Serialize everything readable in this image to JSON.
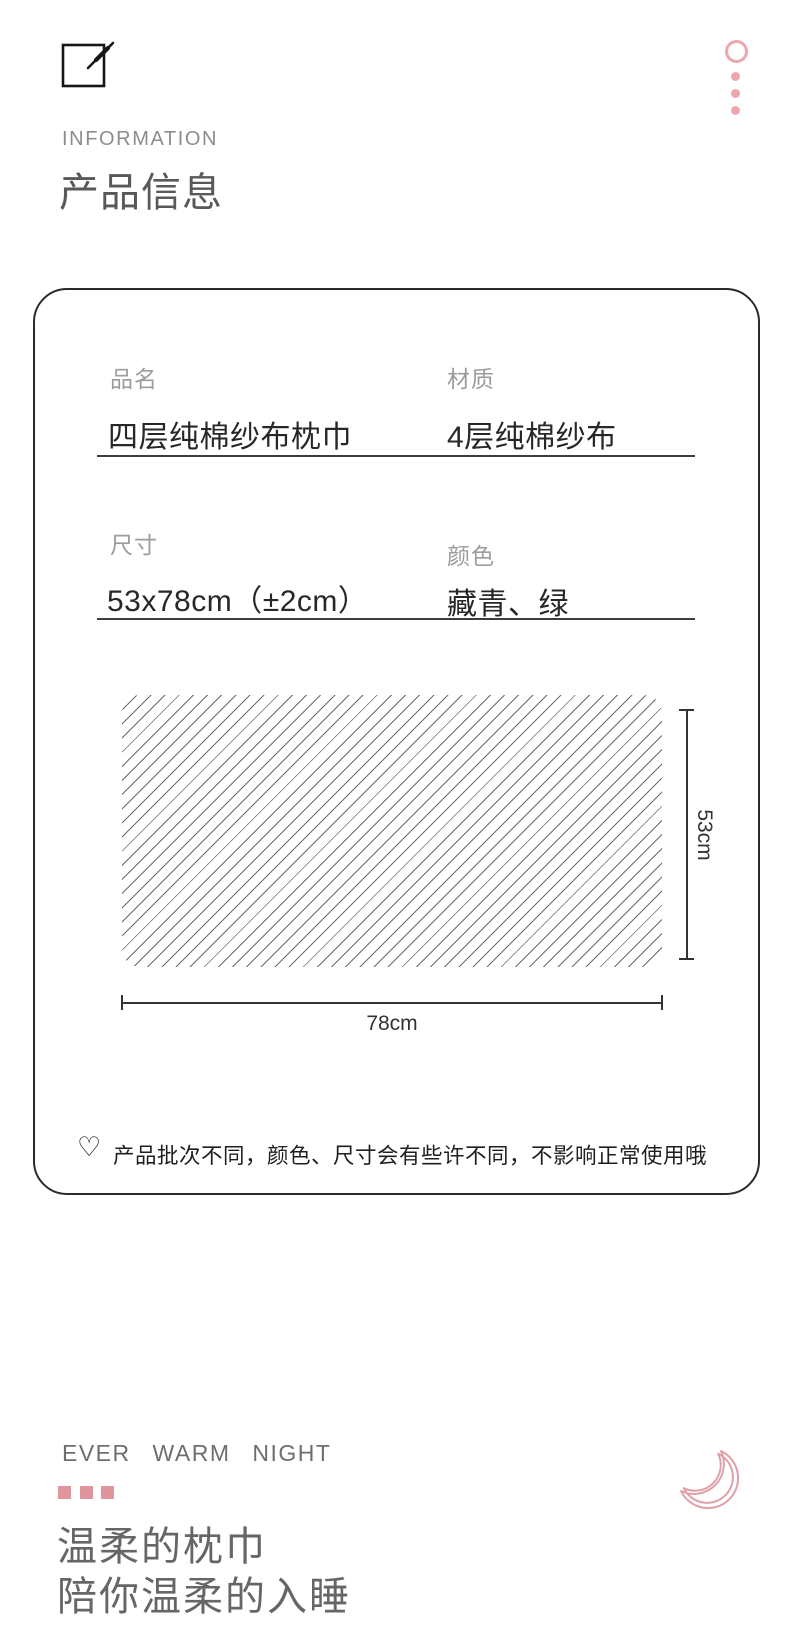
{
  "header": {
    "eyebrow": "INFORMATION",
    "title": "产品信息"
  },
  "card": {
    "fields": [
      {
        "label": "品名",
        "value": "四层纯棉纱布枕巾"
      },
      {
        "label": "材质",
        "value": "4层纯棉纱布"
      },
      {
        "label": "尺寸",
        "value": "53x78cm（±2cm）"
      },
      {
        "label": "颜色",
        "value": "藏青、绿"
      }
    ],
    "diagram": {
      "width_label": "78cm",
      "height_label": "53cm"
    },
    "note": {
      "icon": "♡",
      "text": "产品批次不同，颜色、尺寸会有些许不同，不影响正常使用哦"
    }
  },
  "footer": {
    "tagline": "EVER WARM NIGHT",
    "heading_line1": "温柔的枕巾",
    "heading_line2": "陪你温柔的入睡"
  },
  "icons": {
    "top_left": "pencil-square-icon",
    "top_right": "ring-and-dots-icon",
    "note": "heart-outline-icon",
    "footer": "crescent-moon-icon"
  },
  "colors": {
    "accent_pink": "#eda7ac",
    "square_pink": "#e0959e",
    "moon_pink": "#dfa0a8",
    "card_border": "#2b2b2b",
    "label_gray": "#9c9c9c",
    "value_dark": "#272727",
    "muted_gray": "#6e6e6e",
    "title_gray": "#595959"
  }
}
